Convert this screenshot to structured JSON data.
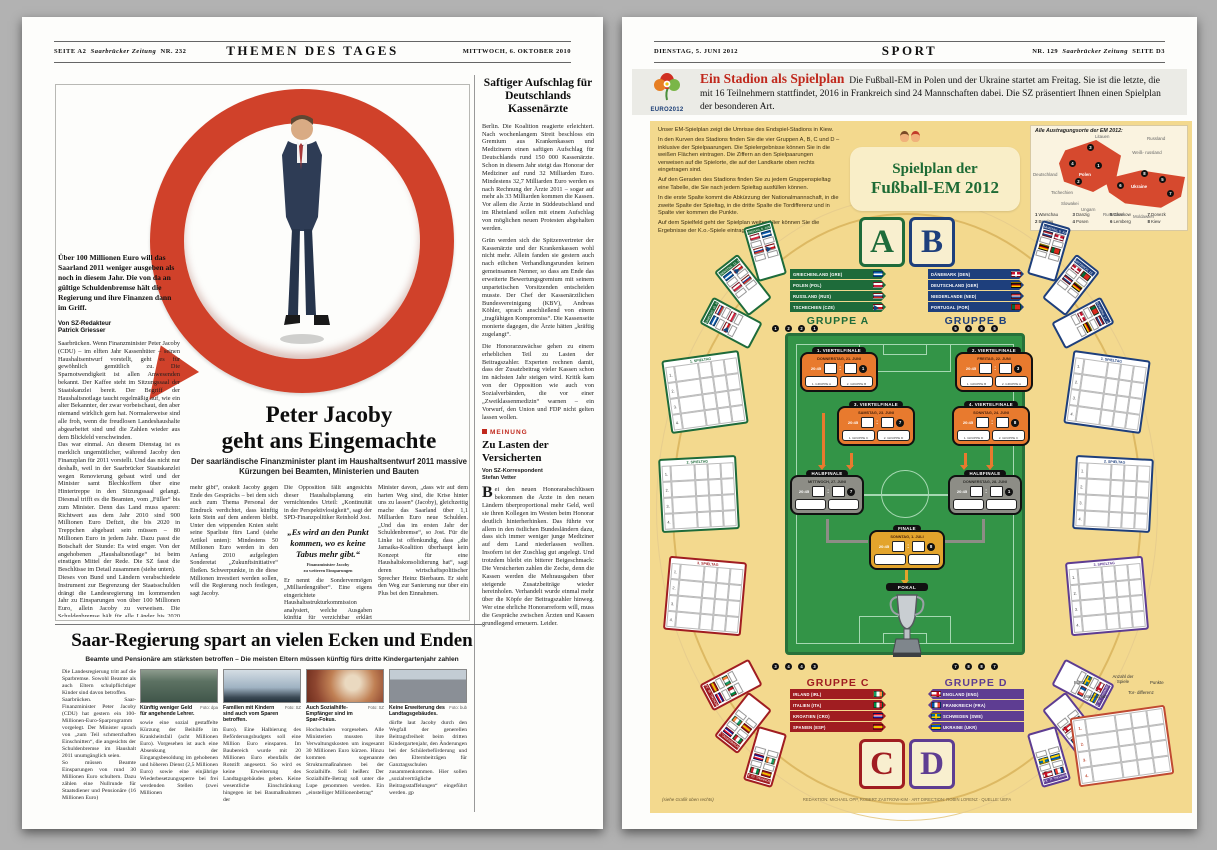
{
  "colors": {
    "accent_red": "#c0281c",
    "ring_red": "#d0412a",
    "info_bg": "#f3d98e",
    "group_a": "#1e6b3a",
    "group_b": "#1e3f7c",
    "group_c": "#a01d21",
    "group_d": "#5e3d92",
    "pitch_green": "#339447",
    "qf_orange": "#e87a2e",
    "sf_gray": "#8d8d86",
    "final_gold": "#e3a42c",
    "map_red": "#d6492e"
  },
  "left_page": {
    "header": {
      "page": "SEITE A2",
      "paper": "Saarbrücker Zeitung",
      "number": "NR. 232",
      "section": "THEMEN DES TAGES",
      "date": "MITTWOCH, 6. OKTOBER 2010"
    },
    "main_article": {
      "intro": "Über 100 Millionen Euro will das Saarland 2011 weniger ausgeben als noch in diesem Jahr. Die von da an gültige Schuldenbremse hält die Regierung und ihre Finanzen dann im Griff.",
      "byline_role": "Von SZ-Redakteur",
      "byline_name": "Patrick Griesser",
      "left_column": "Saarbrücken. Wenn Finanzminister Peter Jacoby (CDU) – im elften Jahr Kassenhüter – seinen Haushaltsentwurf vorstellt, geht es für gewöhnlich gemütlich zu. Die Sparnotwendigkeit ist allen Anwesenden bekannt. Der Kaffee steht im Sitzungssaal der Staatskanzlei bereit. Der Begriff der Haushaltsnotlage taucht regelmäßig auf, wie ein alter Bekannter, der zwar vorbeischaut, den aber niemand wirklich gern hat. Normalerweise sind alle froh, wenn die freudlosen Landeshaushalte abgearbeitet sind und die Zahlen wieder aus dem Blickfeld verschwinden.\nDas war einmal. An diesem Dienstag ist es merklich ungemütlicher, während Jacoby den Finanzplan für 2011 vorstellt. Und das nicht nur deshalb, weil in der Saarbrücker Staatskanzlei wegen Renovierung gebaut wird und der Minister samt Blechkoffern über eine Hintertreppe in den Sitzungssaal gelangt. Diesmal trifft es die Beamten, vom „Füller“ bis zum Minister. Denn das Land muss sparen: Richtwert aus dem Jahr 2010 sind 900 Millionen Euro Defizit, die bis 2020 in Treppchen abgebaut sein müssen – 80 Millionen Euro in jedem Jahr. Dazu passt die Botschaft der Stunde: Es wird enger. Von der angehobenen „Haushaltsnotlage“ ist beim einstigen Mittel der Rede. Die SZ fasst die Beschlüsse im Detail zusammen (siehe unten).\nDieses von Bund und Ländern verabschiedete Instrument zur Begrenzung der Staatsschulden drängt die Landesregierung im kommenden Jahr zu Einsparungen von über 100 Millionen Euro, allein Jacoby zu verweisen. Die Schuldenbremse hält für alle Länder bis 2020 einen schrittweisen Abbau der Neuverschuldung vor.",
      "headline_line1": "Peter Jacoby",
      "headline_line2": "geht ans Eingemachte",
      "subhead": "Der saarländische Finanzminister plant im Haushaltsentwurf 2011 massive Kürzungen bei Beamten, Ministerien und Bauten",
      "column1": "mehr gibt“, orakelt Jacoby gegen Ende des Gesprächs – bei dem sich auch zum Thema Personal der Eindruck verdichtet, dass künftig kein Stein auf dem anderen bleibt. Unter den wippenden Knien steht seine Sparliste fürs Land (siehe Artikel unten): Mindestens 50 Millionen Euro werden in den Anfang 2010 aufgelegten Sonderetat „Zukunftsinitiative“ fließen. Schwerpunkte, in die diese Millionen investiert werden sollen, will die Regierung noch festlegen, sagt Jacoby.",
      "column2_top": "Die Opposition fällt angesichts dieser Haushaltsplanung ein vernichtendes Urteil: „Kontinuität in der Perspektivlosigkeit“, sagt der SPD-Finanzpolitiker Reinhold Jost.",
      "pull_quote": "„Es wird an den Punkt kommen, wo es keine Tabus mehr gibt.“",
      "quote_attribution1": "Finanzminister Jacoby",
      "quote_attribution2": "zu weiteren Einsparungen",
      "column2_bottom": "Er nennt die Sondervermögen „Milliardengräber“. Eine eigens eingerichtete Haushaltsstrukturkommission analysiert, welche Ausgaben künftig für verzichtbar erklärt werden könnten. Konflikte sind da programmiert.",
      "column3": "Minister davon, „dass wir auf dem harten Weg sind, die Krise hinter uns zu lassen“ (Jacoby), gleichzeitig mache das Saarland über 1,1 Milliarden Euro neue Schulden. „Und das im ersten Jahr der Schuldenbremse“, so Jost. Für die Linke ist offenkundig, dass „die Jamaika-Koalition überhaupt kein Konzept für eine Haushaltskonsolidierung hat“, sagt deren wirtschaftspolitischer Sprecher Heinz Bierbaum. Er sieht den Weg zur Sanierung nur über ein Plus bei den Einnahmen."
    },
    "sidebar": {
      "title": "Saftiger Aufschlag für Deutschlands Kassenärzte",
      "para1": "Berlin. Die Koalition reagierte erleichtert. Nach wochenlangem Streit beschloss ein Gremium aus Krankenkassen und Medizinern einen saftigen Aufschlag für Deutschlands rund 150 000 Kassenärzte. Schon in diesem Jahr steigt das Honorar der Mediziner auf rund 32 Milliarden Euro. Mindestens 32,7 Milliarden Euro werden es nach Rechnung der Ärzte 2011 – sogar auf mehr als 33 Milliarden kommen die Kassen. Vor allem die Ärzte in Süddeutschland und im Rheinland sollen mit einem Aufschlag von möglichen neuen Protesten abgehalten werden.",
      "para2": "Grün werden sich die Spitzenvertreter der Kassenärzte und der Krankenkassen wohl nicht mehr. Allein fanden sie gestern auch nach etlichen Verhandlungsrunden keinen gemeinsamen Nenner, so dass am Ende das erweiterte Bewertungsgremium mit seinem unparteiischen Vorsitzenden entscheiden musste. Der Chef der Kassenärztlichen Bundesvereinigung (KBV), Andreas Köhler, sprach anschließend von einem „tragfähigen Kompromiss“. Die Kassenseite monierte dagegen, die Ärzte hätten „kräftig zugelangt“.",
      "para3": "Die Honorarzuwächse gehen zu einem erheblichen Teil zu Lasten der Beitragszahler. Experten rechnen damit, dass der Zusatzbeitrag vieler Kassen schon im nächsten Jahr steigen wird. Kritik kam von der Opposition wie auch von Sozialverbänden, die vor einer „Zweiklassenmedizin“ warnen – ein Vorwurf, den Union und FDP nicht gelten lassen wollen.",
      "opinion": {
        "tag": "MEINUNG",
        "title": "Zu Lasten der Versicherten",
        "byline_role": "Von SZ-Korrespondent",
        "byline_name": "Stefan Vetter",
        "body": "Bei den neuen Honorarabschlüssen bekommen die Ärzte in den neuen Ländern überproportional mehr Geld, weil sie ihren Kollegen im Westen beim Honorar deutlich hinterherhinken. Das führte vor allem in den östlichen Bundesländern dazu, dass sich immer weniger junge Mediziner auf dem Land niederlassen wollten. Insofern ist der Zuschlag gut angelegt. Und trotzdem bleibt ein bitterer Beigeschmack: Die Versicherten zahlen die Zeche, denn die Kassen werden die Mehrausgaben über steigende Zusatzbeiträge wieder hereinholen. Verhandelt wurde einmal mehr über die Köpfe der Beitragszahler hinweg. Wer eine ehrliche Honorarreform will, muss die Gespräche zwischen Ärzten und Kassen grundlegend erneuern. Leider."
      }
    },
    "bottom_article": {
      "headline": "Saar-Regierung spart an vielen Ecken und Enden",
      "subhead": "Beamte und Pensionäre am stärksten betroffen – Die meisten Eltern müssen künftig fürs dritte Kindergartenjahr zahlen",
      "lead": "Die Landesregierung tritt auf die Sparbremse. Sowohl Beamte als auch Eltern schulpflichtiger Kinder sind davon betroffen.\nSaarbrücken. Saar-Finanzminister Peter Jacoby (CDU) hat gestern ein 100-Millionen-Euro-Sparprogramm vorgelegt. Der Minister sprach von „zum Teil schmerzhaften Einschnitten“, die angesichts der Schuldenbremse im Haushalt 2011 unumgänglich seien.\nSo müssen Beamte Einsparungen von rund 30 Millionen Euro schultern. Dazu zählen eine Nullrunde für Staatsdiener und Pensionäre (16 Millionen Euro)",
      "figures": [
        {
          "caption": "Künftig weniger Geld für angehende Lehrer.",
          "credit": "Foto: dpa"
        },
        {
          "caption": "Familien mit Kindern sind auch vom Sparen betroffen.",
          "credit": "Foto: SZ"
        },
        {
          "caption": "Auch Sozialhilfe-Empfänger sind im Spar-Fokus.",
          "credit": "Foto: SZ"
        },
        {
          "caption": "Keine Erweiterung des Landtagsgebäudes.",
          "credit": "Foto: bub"
        }
      ],
      "columns": [
        "sowie eine sozial gestaffelte Kürzung der Beihilfe im Krankheitsfall (acht Millionen Euro). Vorgesehen ist auch eine Absenkung der Eingangsbesoldung im gehobenen und höheren Dienst (2,5 Millionen Euro) sowie eine einjährige Wiederbesetzungssperre bei frei werdenden Stellen (zwei Millionen",
        "Euro). Eine Halbierung des Beförderungsbudgets soll eine Million Euro einsparen. Im Baubereich wurde mit 20 Millionen Euro ebenfalls der Rotstift angesetzt. So wird es keine Erweiterung des Landtagsgebäudes geben. Keine wesentliche Einschränkung hingegen ist bei Baumaßnahmen der",
        "Hochschulen vorgesehen. Alle Ministerien mussten ihre Verwaltungskosten um insgesamt 30 Millionen Euro kürzen. Hinzu kommen sogenannte Strukturmaßnahmen bei der Sozialhilfe. Soll heißen: Der Sozialhilfe-Betrag soll unter die Lupe genommen werden. Ein „einstelliger Millionenbetrag“",
        "dürfte laut Jacoby durch den Wegfall der generellen Beitragsfreiheit beim dritten Kindergartenjahr, den Änderungen bei der Schülerbeförderung und den Elternbeiträgen für Ganztagsschulen zusammenkommen. Hier sollen „sozialverträgliche Beitragsstaffelungen“ eingeführt werden. gp"
      ]
    }
  },
  "right_page": {
    "header": {
      "date": "DIENSTAG, 5. JUNI 2012",
      "section": "SPORT",
      "number": "NR. 129",
      "paper": "Saarbrücker Zeitung",
      "page": "SEITE D3"
    },
    "banner": {
      "logo": "EURO2012",
      "title": "Ein Stadion als Spielplan",
      "text": "Die Fußball-EM in Polen und der Ukraine startet am Freitag. Sie ist die letzte, die mit 16 Teilnehmern stattfindet, 2016 in Frankreich sind 24 Mannschaften dabei. Die SZ präsentiert Ihnen einen Spielplan der besonderen Art."
    },
    "infographic": {
      "instructions": [
        "Unser EM-Spielplan zeigt die Umrisse des Endspiel-Stadions in Kiew.",
        "In den Kurven des Stadions finden Sie die vier Gruppen A, B, C und D – inklusive der Spielpaarungen. Die Spielergebnisse können Sie in die weißen Flächen eintragen. Die Ziffern an den Spielpaarungen verweisen auf die Spielorte, die auf der Landkarte oben rechts eingetragen sind.",
        "Auf den Geraden des Stadions finden Sie zu jedem Gruppenspieltag eine Tabelle, die Sie nach jedem Spieltag ausfüllen können.",
        "In die erste Spalte kommt die Abkürzung der Nationalmannschaft, in die zweite Spalte der Spieltag, in die dritte Spalte die Tordifferenz und in Spalte vier kommen die Punkte.",
        "Auf dem Spielfeld geht der Spielplan weiter. Hier können Sie die Ergebnisse der K.o.-Spiele eintragen."
      ],
      "title_line1": "Spielplan der",
      "title_line2": "Fußball-EM 2012",
      "map": {
        "label": "Alle Austragungsorte der EM 2012:",
        "countries": {
          "litauen": "Litauen",
          "russland": "Russland",
          "weissrussland": "Weiß- russland",
          "deutschland": "Deutschland",
          "polen": "Polen",
          "tschechien": "Tschechien",
          "slowakei": "Slowakei",
          "ungarn": "Ungarn",
          "rumaenien": "Rumänien",
          "moldawien": "Moldawien",
          "ukraine": "Ukraine"
        },
        "venues": [
          {
            "n": "1",
            "city": "Warschau"
          },
          {
            "n": "2",
            "city": "Breslau"
          },
          {
            "n": "3",
            "city": "Danzig"
          },
          {
            "n": "4",
            "city": "Posen"
          },
          {
            "n": "5",
            "city": "Charkow"
          },
          {
            "n": "6",
            "city": "Lemberg"
          },
          {
            "n": "7",
            "city": "Donezk"
          },
          {
            "n": "8",
            "city": "Kiew"
          }
        ]
      },
      "groups": [
        {
          "letter": "A",
          "label": "GRUPPE A",
          "color": "#1e6b3a",
          "teams": [
            {
              "name": "GRIECHENLAND (GRE)",
              "code": "gre"
            },
            {
              "name": "POLEN (POL)",
              "code": "pol"
            },
            {
              "name": "RUSSLAND (RUS)",
              "code": "rus"
            },
            {
              "name": "TSCHECHIEN (CZE)",
              "code": "cze"
            }
          ],
          "matchdays": [
            "FREITAG, 8. JUNI",
            "DIENSTAG, 12. JUNI",
            "SAMSTAG, 16. JUNI"
          ]
        },
        {
          "letter": "B",
          "label": "GRUPPE B",
          "color": "#1e3f7c",
          "teams": [
            {
              "name": "DÄNEMARK (DEN)",
              "code": "den"
            },
            {
              "name": "DEUTSCHLAND (GER)",
              "code": "ger"
            },
            {
              "name": "NIEDERLANDE (NED)",
              "code": "ned"
            },
            {
              "name": "PORTUGAL (POR)",
              "code": "por"
            }
          ],
          "matchdays": [
            "SAMSTAG, 9. JUNI",
            "MITTWOCH, 13. JUNI",
            "SONNTAG, 17. JUNI"
          ]
        },
        {
          "letter": "C",
          "label": "GRUPPE C",
          "color": "#a01d21",
          "teams": [
            {
              "name": "IRLAND (IRL)",
              "code": "irl"
            },
            {
              "name": "ITALIEN (ITA)",
              "code": "ita"
            },
            {
              "name": "KROATIEN (CRO)",
              "code": "cro"
            },
            {
              "name": "SPANIEN (ESP)",
              "code": "esp"
            }
          ],
          "matchdays": [
            "SONNTAG, 10. JUNI",
            "DONNERSTAG, 14. JUNI",
            "MONTAG, 18. JUNI"
          ]
        },
        {
          "letter": "D",
          "label": "GRUPPE D",
          "color": "#5e3d92",
          "teams": [
            {
              "name": "ENGLAND (ENG)",
              "code": "eng"
            },
            {
              "name": "FRANKREICH (FRA)",
              "code": "fra"
            },
            {
              "name": "SCHWEDEN (SWE)",
              "code": "swe"
            },
            {
              "name": "UKRAINE (UKR)",
              "code": "ukr"
            }
          ],
          "matchdays": [
            "MONTAG, 11. JUNI",
            "FREITAG, 15. JUNI",
            "DIENSTAG, 19. JUNI"
          ]
        }
      ],
      "venue_dots": {
        "a": [
          "1",
          "2",
          "2",
          "1"
        ],
        "b": [
          "5",
          "6",
          "6",
          "5"
        ],
        "c": [
          "3",
          "4",
          "4",
          "3"
        ],
        "d": [
          "7",
          "8",
          "8",
          "7"
        ]
      },
      "knockout": {
        "quarterfinals": [
          {
            "title": "1. VIERTELFINALE",
            "date": "DONNERSTAG, 21. JUNI",
            "time": "20:45",
            "venue": "1",
            "home": "1. GRUPPE A",
            "away": "2. GRUPPE B"
          },
          {
            "title": "2. VIERTELFINALE",
            "date": "FREITAG, 22. JUNI",
            "time": "20:45",
            "venue": "3",
            "home": "1. GRUPPE B",
            "away": "2. GRUPPE A"
          },
          {
            "title": "3. VIERTELFINALE",
            "date": "SAMSTAG, 23. JUNI",
            "time": "20:45",
            "venue": "7",
            "home": "1. GRUPPE C",
            "away": "2. GRUPPE D"
          },
          {
            "title": "4. VIERTELFINALE",
            "date": "SONNTAG, 24. JUNI",
            "time": "20:45",
            "venue": "8",
            "home": "1. GRUPPE D",
            "away": "2. GRUPPE C"
          }
        ],
        "semifinals": [
          {
            "title": "HALBFINALE",
            "date": "MITTWOCH, 27. JUNI",
            "time": "20:45",
            "venue": "7"
          },
          {
            "title": "HALBFINALE",
            "date": "DONNERSTAG, 28. JUNI",
            "time": "20:45",
            "venue": "1"
          }
        ],
        "final": {
          "title": "FINALE",
          "date": "SONNTAG, 1. JULI",
          "time": "20:45",
          "venue": "8"
        },
        "trophy_label": "POKAL"
      },
      "matchday_tables": {
        "labels": [
          "1. SPIELTAG",
          "2. SPIELTAG",
          "3. SPIELTAG"
        ],
        "row_numbers": [
          "1.",
          "2.",
          "3.",
          "4."
        ]
      },
      "legend": {
        "platz": "Platz",
        "mannschaft": "Mannschaft",
        "spiele": "Anzahl der Spiele",
        "tordifferenz": "Tor- differenz",
        "punkte": "Punkte",
        "rows": [
          "1.",
          "2.",
          "3.",
          "4."
        ]
      },
      "note": "(siehe Grafik oben rechts)",
      "credits": "REDAKTION: MICHAEL OPP, ROBERT ZASTROW-KIM · ART DIRECTION: ROBIN LORENZ · QUELLE: UEFA"
    }
  }
}
